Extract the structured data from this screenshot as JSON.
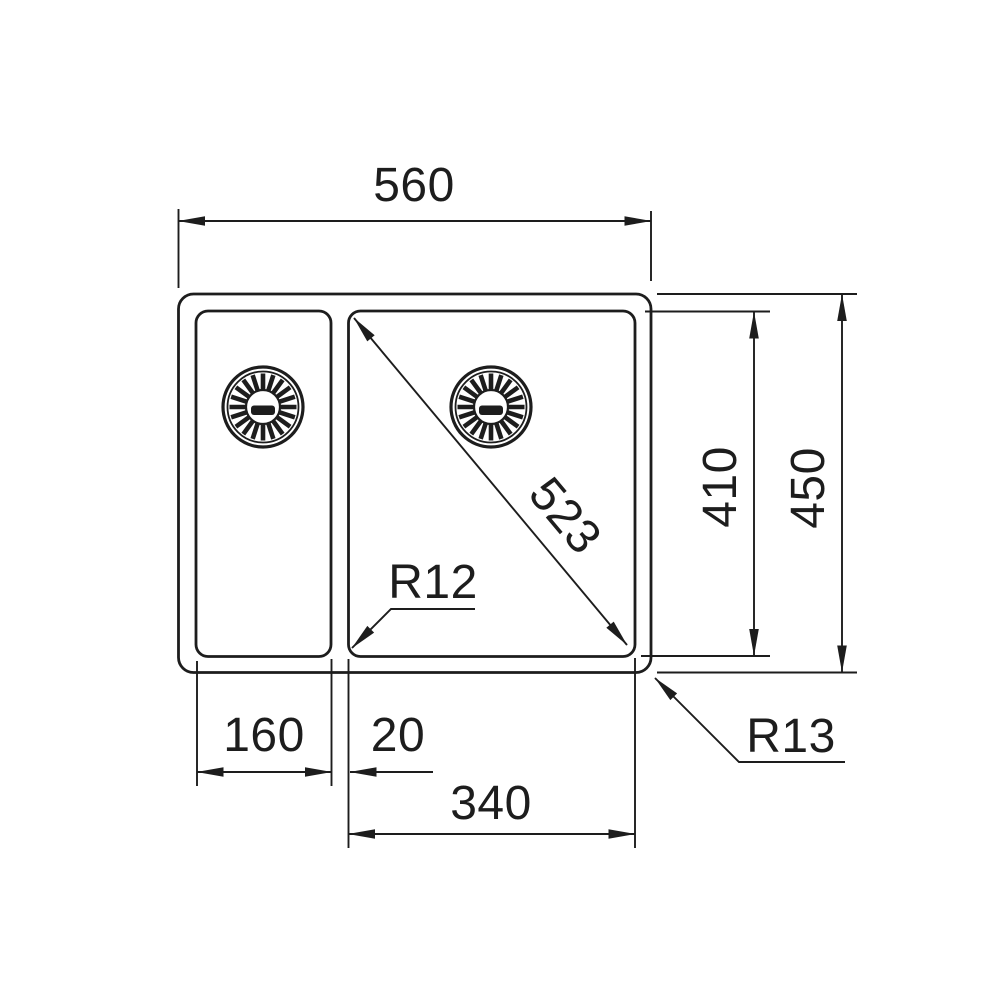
{
  "drawing": {
    "labels": {
      "overall_width": "560",
      "bowl_diagonal": "523",
      "inner_corner_radius": "R12",
      "inner_depth": "410",
      "overall_depth": "450",
      "small_bowl_width": "160",
      "divider_width": "20",
      "large_bowl_width": "340",
      "outer_corner_radius": "R13"
    },
    "colors": {
      "line": "#1d1d1d",
      "background": "#ffffff"
    }
  }
}
